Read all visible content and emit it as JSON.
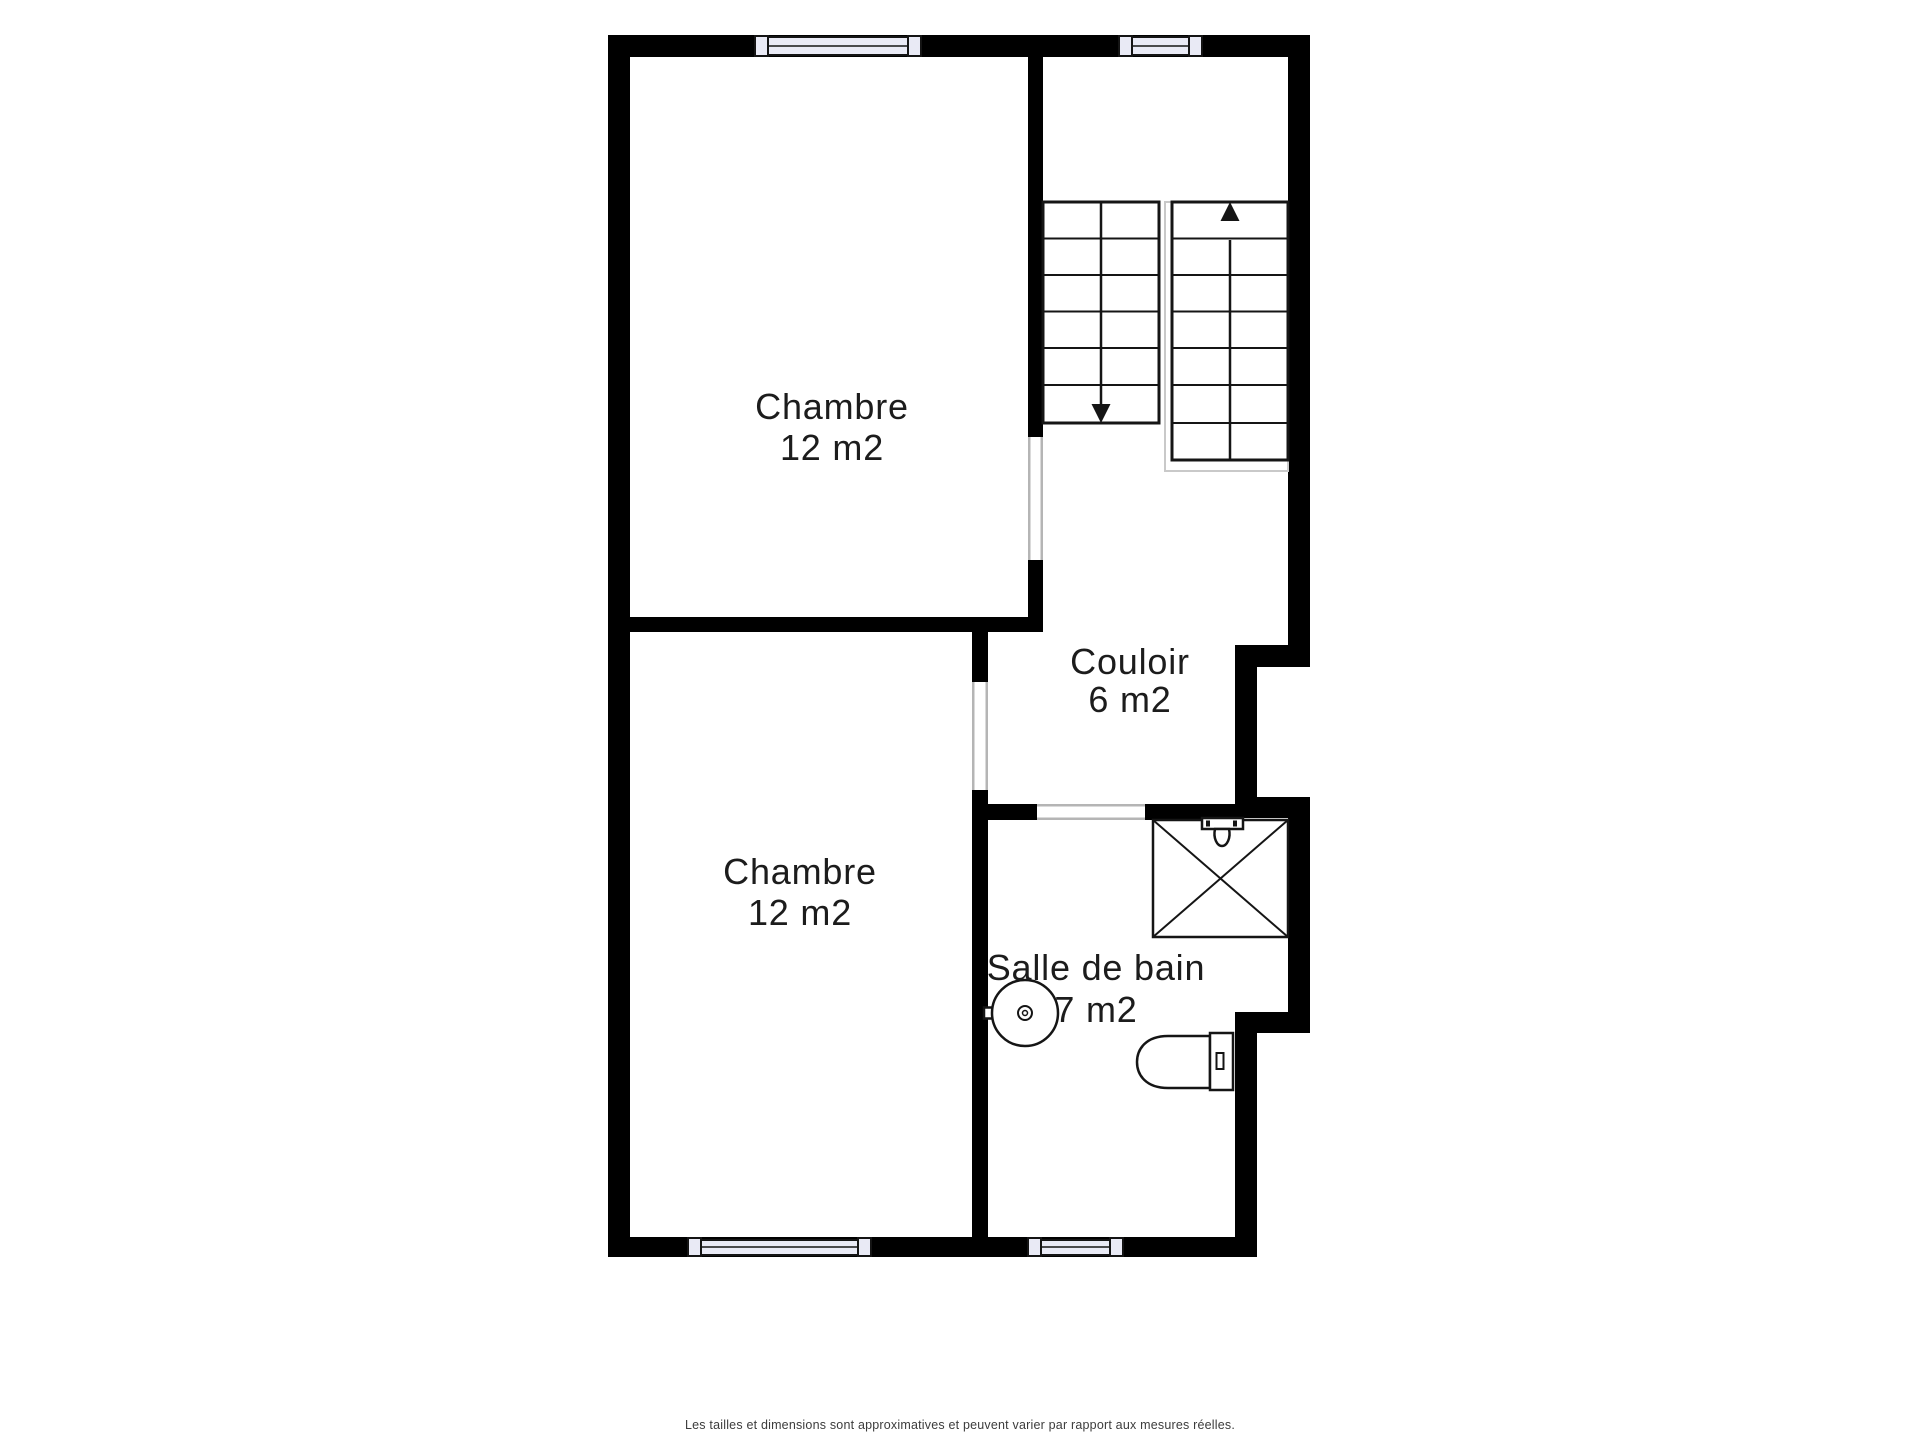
{
  "plan": {
    "rooms": [
      {
        "id": "bedroom-top",
        "label": "Chambre",
        "area": "12 m2"
      },
      {
        "id": "bedroom-bottom",
        "label": "Chambre",
        "area": "12 m2"
      },
      {
        "id": "hallway",
        "label": "Couloir",
        "area": "6 m2"
      },
      {
        "id": "bathroom",
        "label": "Salle de bain",
        "area": "7 m2"
      }
    ],
    "fixtures": [
      "stairs",
      "shower",
      "sink",
      "toilet"
    ],
    "window_count": 4
  },
  "footer": {
    "disclaimer": "Les tailles et dimensions sont approximatives et peuvent varier par rapport aux mesures réelles."
  },
  "colors": {
    "wall": "#000000",
    "window_fill": "#e9eaf5",
    "window_stroke": "#141414",
    "door_line": "#b5b5b5",
    "stair_outline": "#c9c9c9",
    "line": "#151515",
    "text": "#1c1c1c",
    "footer_text": "#3c3c3c"
  }
}
